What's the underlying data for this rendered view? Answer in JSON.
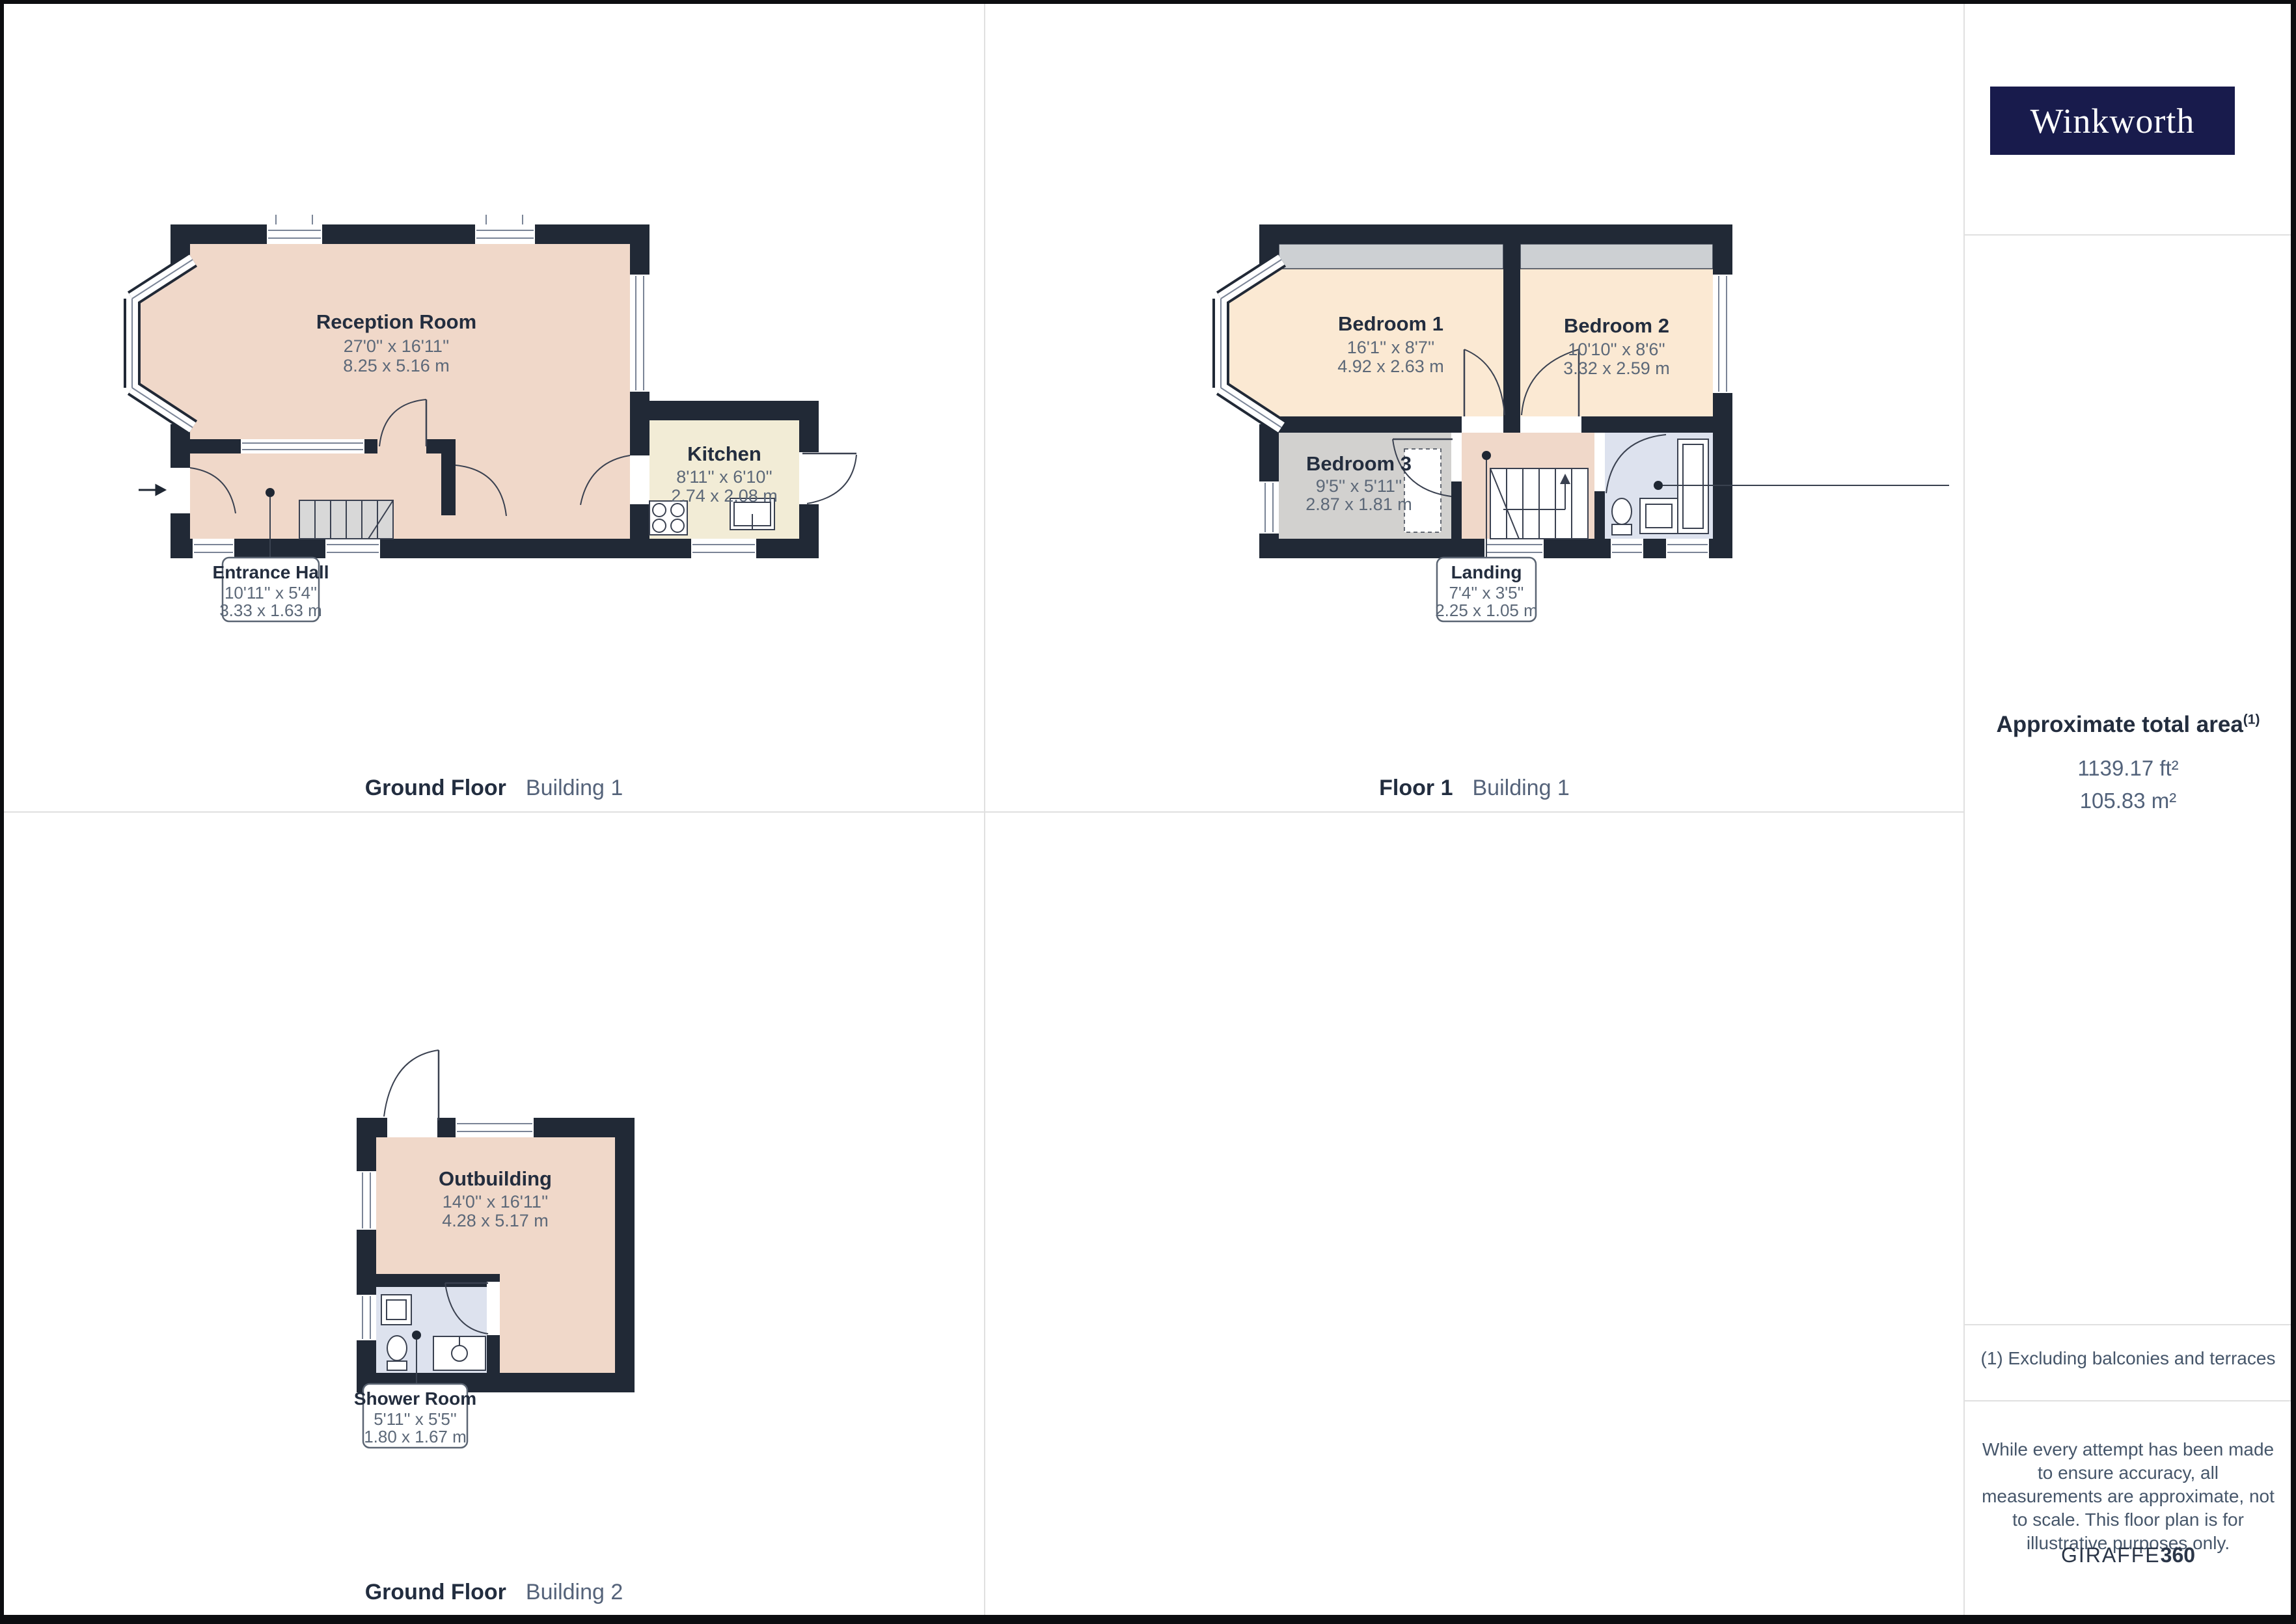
{
  "brand": {
    "name": "Winkworth"
  },
  "sidebar": {
    "area_title": "Approximate total area",
    "area_footnote_marker": "(1)",
    "area_ft2": "1139.17 ft²",
    "area_m2": "105.83 m²",
    "footnote": "(1) Excluding balconies and terraces",
    "disclaimer": "While every attempt has been made to ensure accuracy, all measurements are approximate, not to scale. This floor plan is for illustrative purposes only.",
    "generator_regular": "GIRAFFE",
    "generator_bold": "360"
  },
  "floors": [
    {
      "caption_title": "Ground Floor",
      "caption_subtitle": "Building 1",
      "rooms": [
        {
          "name": "Reception Room",
          "dims_imperial": "27'0'' x 16'11''",
          "dims_metric": "8.25 x 5.16 m"
        },
        {
          "name": "Kitchen",
          "dims_imperial": "8'11'' x 6'10''",
          "dims_metric": "2.74 x 2.08 m"
        },
        {
          "name": "Entrance Hall",
          "dims_imperial": "10'11'' x 5'4''",
          "dims_metric": "3.33 x 1.63 m"
        }
      ]
    },
    {
      "caption_title": "Floor 1",
      "caption_subtitle": "Building 1",
      "rooms": [
        {
          "name": "Bedroom 1",
          "dims_imperial": "16'1'' x 8'7''",
          "dims_metric": "4.92 x 2.63 m"
        },
        {
          "name": "Bedroom 2",
          "dims_imperial": "10'10'' x 8'6''",
          "dims_metric": "3.32 x 2.59 m"
        },
        {
          "name": "Bedroom 3",
          "dims_imperial": "9'5'' x 5'11''",
          "dims_metric": "2.87 x 1.81 m"
        },
        {
          "name": "Landing",
          "dims_imperial": "7'4'' x 3'5''",
          "dims_metric": "2.25 x 1.05 m"
        }
      ]
    },
    {
      "caption_title": "Ground Floor",
      "caption_subtitle": "Building 2",
      "rooms": [
        {
          "name": "Outbuilding",
          "dims_imperial": "14'0'' x 16'11''",
          "dims_metric": "4.28 x 5.17 m"
        },
        {
          "name": "Shower Room",
          "dims_imperial": "5'11'' x 5'5''",
          "dims_metric": "1.80 x 1.67 m"
        }
      ]
    }
  ],
  "colors": {
    "wall": "#212936",
    "room_pink": "#f0d8c9",
    "room_peach": "#fbe9d3",
    "room_cream": "#f2ecd6",
    "room_gray": "#d2d1cf",
    "room_blue": "#dde2ee",
    "brand_navy": "#181b4c",
    "title_dark": "#232d3e",
    "text_muted": "#5c6878"
  }
}
